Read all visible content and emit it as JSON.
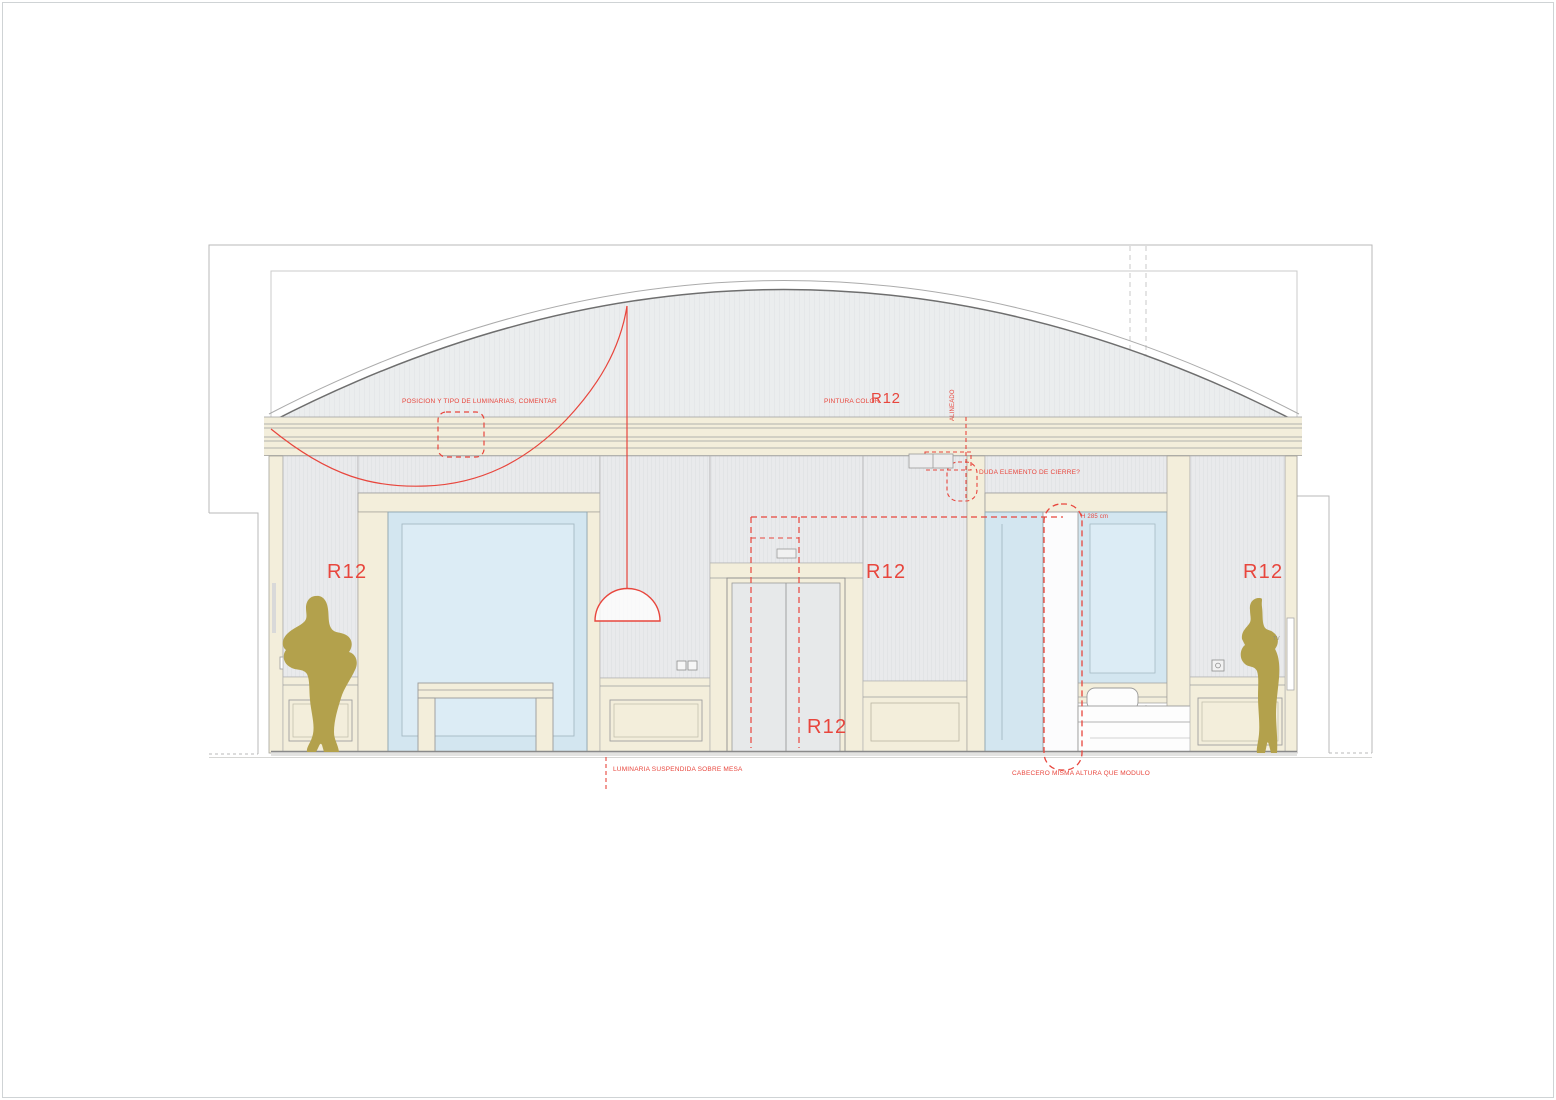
{
  "sheet": {
    "width_px": 1556,
    "height_px": 1100,
    "kind": "interior elevation drawing"
  },
  "drawing": {
    "annotations": {
      "posicion_luminarias": "POSICION Y TIPO DE LUMINARIAS, COMENTAR",
      "pintura_color_prefix": "PINTURA COLOR",
      "finish_code": "R12",
      "alineado": "ALINEADO",
      "duda_cierre": "DUDA ELEMENTO DE CIERRE?",
      "altura_modulo": "H 285 cm",
      "luminaria_suspendida": "LUMINARIA SUSPENDIDA SOBRE MESA",
      "cabecero_altura": "CABECERO MISMA ALTURA QUE MODULO",
      "tv_label": "TV"
    },
    "colors": {
      "annotation_red": "#e8463d",
      "silhouette_olive": "#b3a14c",
      "wall_cream": "#f3eedb",
      "wall_gray": "#e9eaec",
      "glass_blue": "#d3e6f0",
      "glass_inner_blue": "#dcecf5",
      "vault_gray": "#ebedee",
      "line_gray": "#9a9a9a"
    }
  }
}
